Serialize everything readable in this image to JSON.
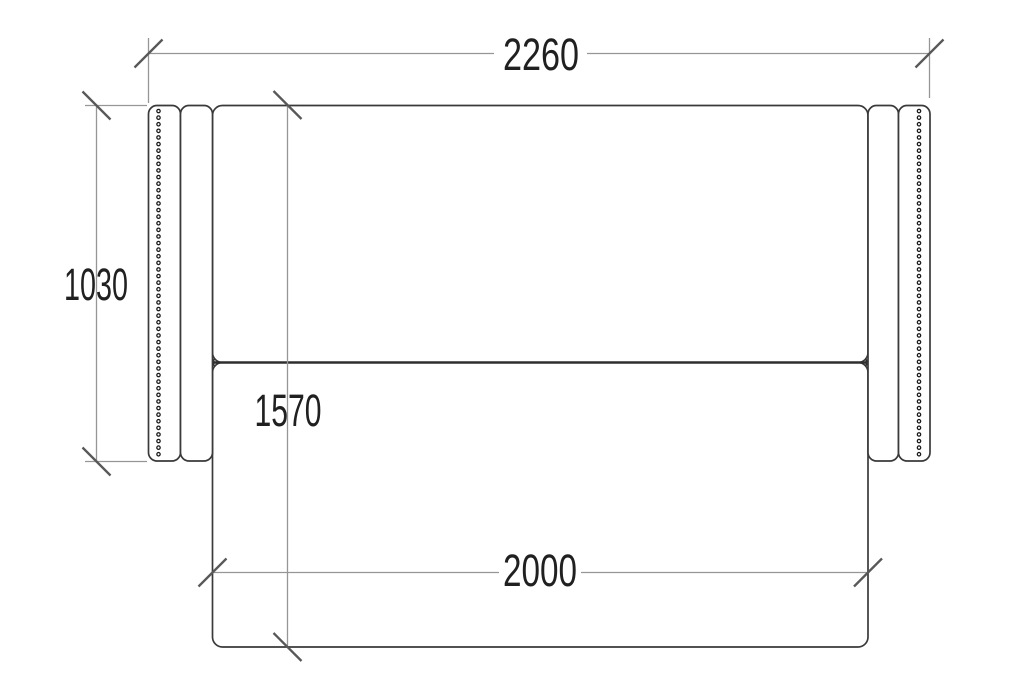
{
  "drawing": {
    "type": "furniture technical drawing - sofa bed, top view plan",
    "dimensions": {
      "overall_width": "2260",
      "sofa_depth": "1030",
      "unfolded_depth": "1570",
      "bed_width": "2000"
    },
    "colors": {
      "background": "#ffffff",
      "outline": "#3a3a3a",
      "seam_divider": "#2e2e2e",
      "dimension_line": "#969696",
      "tick_mark": "#585858",
      "text": "#202020"
    }
  }
}
